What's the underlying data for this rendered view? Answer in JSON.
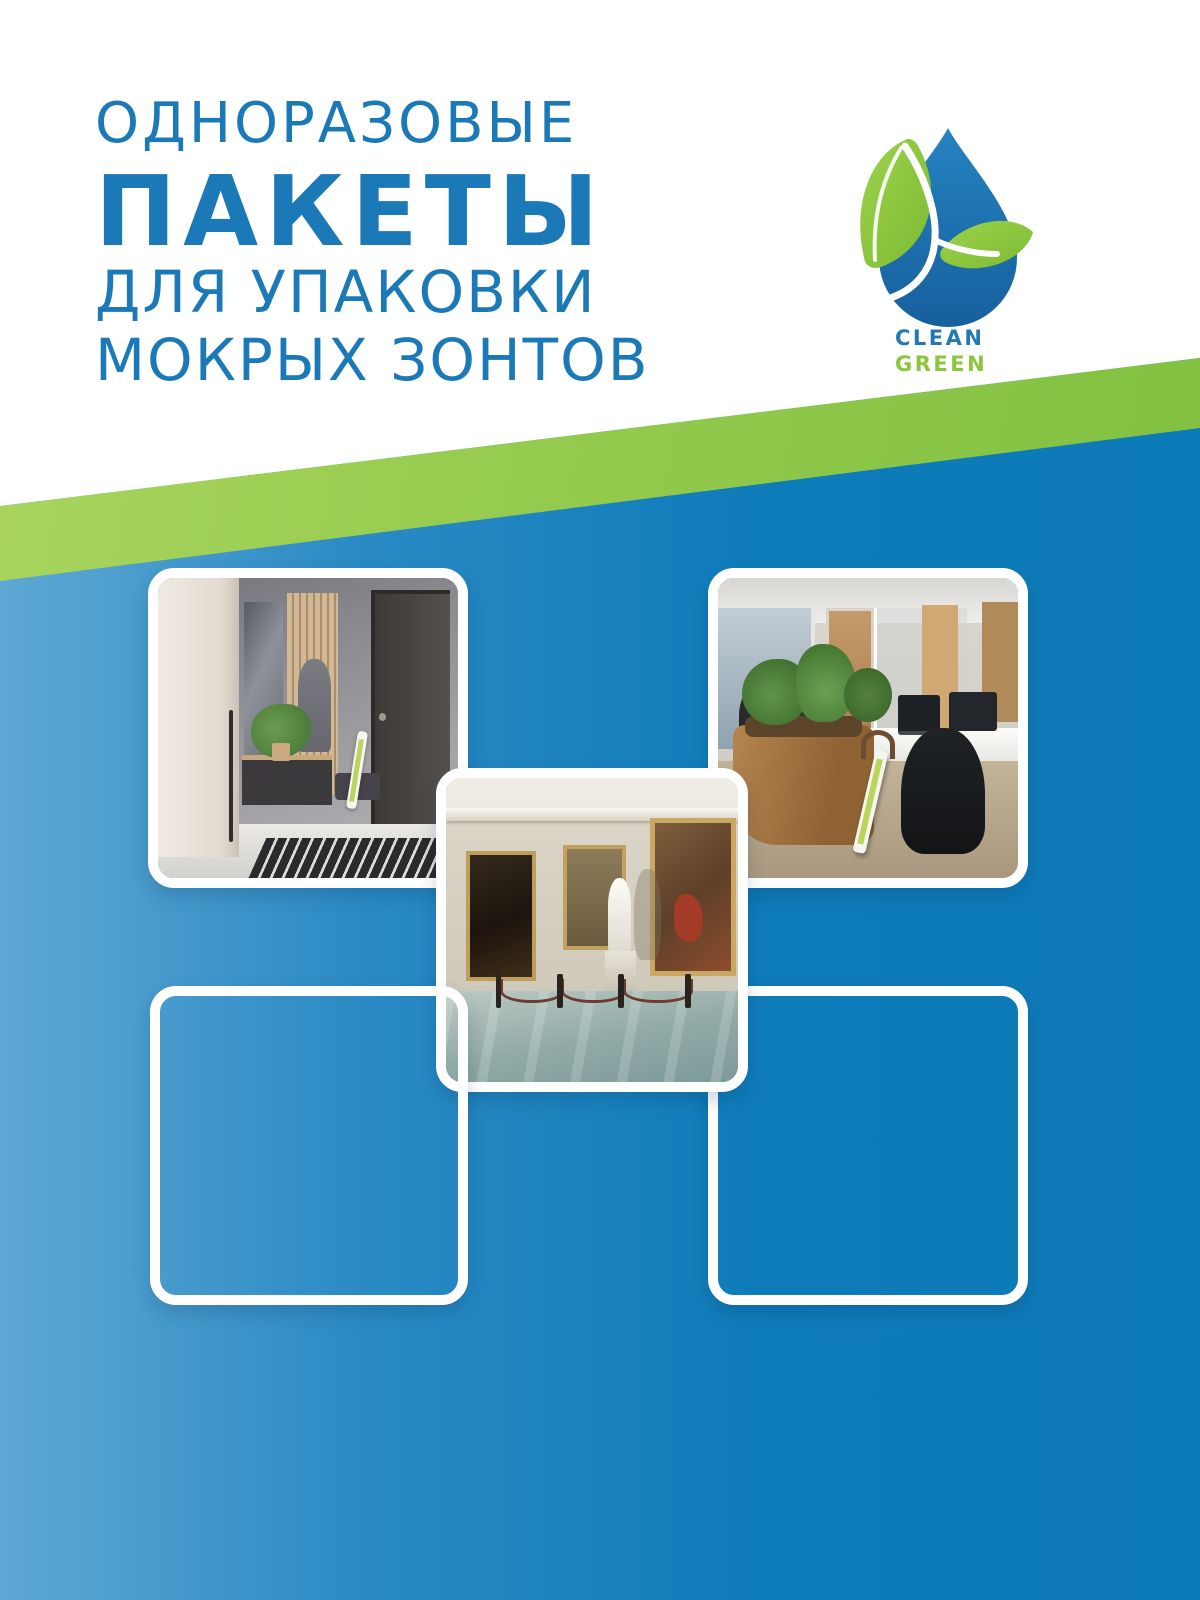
{
  "title": {
    "line1": "ОДНОРАЗОВЫЕ",
    "line2": "ПАКЕТЫ",
    "line3": "ДЛЯ УПАКОВКИ",
    "line4": "МОКРЫХ ЗОНТОВ"
  },
  "logo": {
    "clean": "CLEAN",
    "green": "GREEN"
  },
  "labels": {
    "home": "ДЛЯ ДОМА",
    "office": "ДЛЯ ОФИСА",
    "museum": "ДЛЯ МУЗЕЕВ",
    "cafe": "ДЛЯ КАФЕ",
    "medical_line1": "ДЛЯ МЕДИЦИНСКИХ",
    "medical_line2": "УЧРЕЖДЕНИЙ"
  },
  "footer": {
    "line1": "Чехол для зонта эффективно сохраняет",
    "line2": "полы сухими в дождливую погоду,",
    "line3": "снижая риск скольжения"
  },
  "colors": {
    "title_blue": "#1b79b8",
    "background_blue": "#0f7cba",
    "background_blue_light": "#5ea8d4",
    "stripe_green_light": "#abd660",
    "stripe_green_dark": "#7cbd3e",
    "logo_drop_blue": "#1d71ad",
    "logo_leaf_green": "#8cc63e",
    "caption_white": "#ffffff"
  }
}
